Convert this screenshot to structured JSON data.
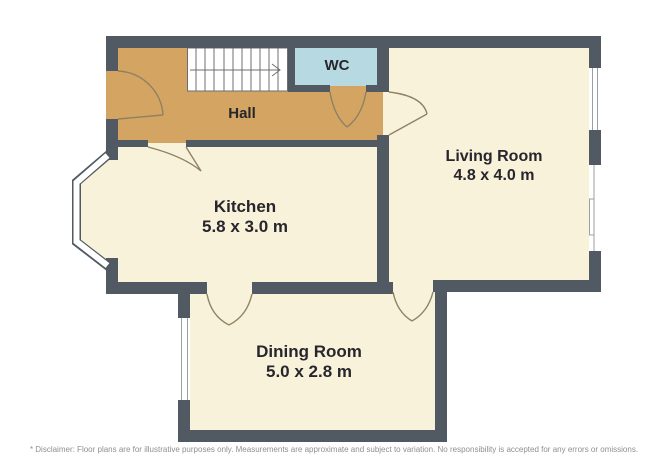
{
  "colors": {
    "wall": "#515a63",
    "floor": "#f9f2da",
    "hall-floor": "#d4a462",
    "wc-floor": "#b7dae2",
    "door-arc": "#8f8164",
    "stair-line": "#6f6f6f",
    "window-frame": "#9aa0a6",
    "label-text": "#26262c",
    "disclaimer-text": "#8f8f8f"
  },
  "rooms": {
    "hall": {
      "name": "Hall"
    },
    "wc": {
      "name": "WC"
    },
    "living": {
      "name": "Living Room",
      "dims": "4.8 x 4.0 m"
    },
    "kitchen": {
      "name": "Kitchen",
      "dims": "5.8 x 3.0 m"
    },
    "dining": {
      "name": "Dining Room",
      "dims": "5.0 x 2.8 m"
    }
  },
  "disclaimer": "* Disclaimer: Floor plans are for illustrative purposes only. Measurements are approximate and subject to variation. No responsibility is accepted for any errors or omissions."
}
